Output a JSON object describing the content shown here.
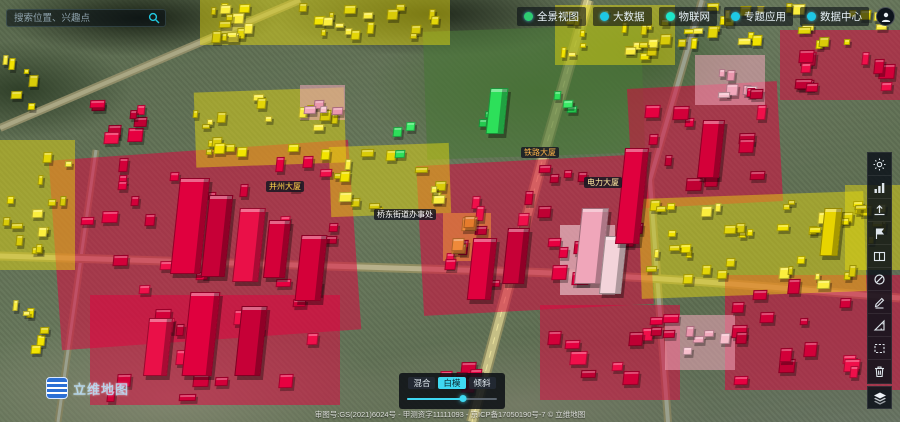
{
  "search": {
    "placeholder": "搜索位置、兴趣点"
  },
  "nav": {
    "items": [
      {
        "label": "全景视图",
        "icon": "panorama-icon",
        "color": "#2ecc71"
      },
      {
        "label": "大数据",
        "icon": "big-data-icon",
        "color": "#1ec8e6"
      },
      {
        "label": "物联网",
        "icon": "iot-icon",
        "color": "#1ee6c8"
      },
      {
        "label": "专题应用",
        "icon": "thematic-apps-icon",
        "color": "#1ec8e6"
      },
      {
        "label": "数据中心",
        "icon": "data-center-icon",
        "color": "#1ec8e6"
      }
    ]
  },
  "toolbar": {
    "buttons": [
      "brightness",
      "statistics",
      "submit-view",
      "flag-mark",
      "split-screen",
      "disable-rotate",
      "draw-pencil",
      "measure",
      "select-area",
      "clear-delete"
    ],
    "layers_button": "layers"
  },
  "mode_panel": {
    "buttons": [
      {
        "label": "混合",
        "active": false
      },
      {
        "label": "白模",
        "active": true
      },
      {
        "label": "倾斜",
        "active": false
      }
    ],
    "slider_percent": 62
  },
  "branding": {
    "watermark": "立维地图",
    "attribution": "审图号:GS(2021)6024号 - 甲测资字11111093 - 京ICP备17050190号-7 © 立维地图"
  },
  "theme": {
    "accent_cyan": "#3fd8f2",
    "building_red": "#e60040",
    "building_yellow": "#f2e300",
    "building_pink": "#f0a6ba",
    "building_green": "#2de05a",
    "building_orange": "#ef8a3a"
  },
  "map": {
    "labels": [
      {
        "text": "并州大厦",
        "x": 266,
        "y": 181,
        "tc": "#ffd24a"
      },
      {
        "text": "桥东街道办事处",
        "x": 374,
        "y": 209,
        "tc": "#ffffff"
      },
      {
        "text": "铁路大厦",
        "x": 521,
        "y": 147,
        "tc": "#ffb34a"
      },
      {
        "text": "电力大厦",
        "x": 584,
        "y": 177,
        "tc": "#ffe9a0"
      }
    ],
    "zones": [
      {
        "x": 425,
        "y": 28,
        "w": 218,
        "h": 128,
        "c": "Gp",
        "r": -2
      },
      {
        "x": 55,
        "y": 150,
        "w": 300,
        "h": 190,
        "c": "R",
        "r": -4
      },
      {
        "x": 420,
        "y": 160,
        "w": 230,
        "h": 150,
        "c": "R",
        "r": -3
      },
      {
        "x": 630,
        "y": 85,
        "w": 150,
        "h": 120,
        "c": "R",
        "r": -3
      },
      {
        "x": 725,
        "y": 275,
        "w": 180,
        "h": 115,
        "c": "R",
        "r": 0
      },
      {
        "x": 90,
        "y": 295,
        "w": 250,
        "h": 110,
        "c": "R",
        "r": 0
      },
      {
        "x": 540,
        "y": 305,
        "w": 140,
        "h": 95,
        "c": "R",
        "r": 0
      },
      {
        "x": 780,
        "y": 30,
        "w": 120,
        "h": 70,
        "c": "R",
        "r": 0
      },
      {
        "x": 640,
        "y": 195,
        "w": 225,
        "h": 100,
        "c": "Y",
        "r": -2
      },
      {
        "x": 195,
        "y": 90,
        "w": 150,
        "h": 75,
        "c": "Y",
        "r": -2
      },
      {
        "x": 0,
        "y": 140,
        "w": 75,
        "h": 130,
        "c": "Y",
        "r": 0
      },
      {
        "x": 200,
        "y": 0,
        "w": 250,
        "h": 45,
        "c": "Y",
        "r": 0
      },
      {
        "x": 555,
        "y": 5,
        "w": 120,
        "h": 60,
        "c": "Y",
        "r": 0
      },
      {
        "x": 845,
        "y": 185,
        "w": 55,
        "h": 85,
        "c": "Y",
        "r": 0
      },
      {
        "x": 330,
        "y": 145,
        "w": 120,
        "h": 70,
        "c": "Y",
        "r": -2
      },
      {
        "x": 695,
        "y": 55,
        "w": 70,
        "h": 50,
        "c": "P",
        "r": 0
      },
      {
        "x": 665,
        "y": 315,
        "w": 70,
        "h": 55,
        "c": "P",
        "r": 0
      },
      {
        "x": 560,
        "y": 225,
        "w": 55,
        "h": 70,
        "c": "W",
        "r": 0
      },
      {
        "x": 300,
        "y": 85,
        "w": 45,
        "h": 35,
        "c": "P",
        "r": 0
      },
      {
        "x": 443,
        "y": 213,
        "w": 48,
        "h": 48,
        "c": "O",
        "r": 0
      }
    ],
    "clusters": [
      {
        "x": 205,
        "y": 2,
        "w": 235,
        "h": 42,
        "c": "Y",
        "n": 30
      },
      {
        "x": 560,
        "y": 8,
        "w": 115,
        "h": 55,
        "c": "Y",
        "n": 18
      },
      {
        "x": 648,
        "y": 2,
        "w": 245,
        "h": 48,
        "c": "Y",
        "n": 28
      },
      {
        "x": 700,
        "y": 55,
        "w": 65,
        "h": 45,
        "c": "P",
        "n": 6
      },
      {
        "x": 790,
        "y": 32,
        "w": 108,
        "h": 62,
        "c": "R",
        "n": 10
      },
      {
        "x": 640,
        "y": 88,
        "w": 135,
        "h": 110,
        "c": "R",
        "n": 14
      },
      {
        "x": 55,
        "y": 88,
        "w": 95,
        "h": 62,
        "c": "R",
        "n": 8
      },
      {
        "x": 2,
        "y": 145,
        "w": 70,
        "h": 120,
        "c": "Y",
        "n": 14
      },
      {
        "x": 2,
        "y": 52,
        "w": 45,
        "h": 60,
        "c": "Y",
        "n": 6
      },
      {
        "x": 192,
        "y": 92,
        "w": 150,
        "h": 70,
        "c": "Y",
        "n": 20
      },
      {
        "x": 300,
        "y": 85,
        "w": 45,
        "h": 32,
        "c": "P",
        "n": 4
      },
      {
        "x": 332,
        "y": 148,
        "w": 118,
        "h": 65,
        "c": "Y",
        "n": 14
      },
      {
        "x": 62,
        "y": 152,
        "w": 285,
        "h": 155,
        "c": "R",
        "n": 24
      },
      {
        "x": 430,
        "y": 158,
        "w": 215,
        "h": 145,
        "c": "R",
        "n": 22
      },
      {
        "x": 445,
        "y": 215,
        "w": 46,
        "h": 46,
        "c": "O",
        "n": 4
      },
      {
        "x": 645,
        "y": 198,
        "w": 212,
        "h": 92,
        "c": "Y",
        "n": 34
      },
      {
        "x": 848,
        "y": 188,
        "w": 50,
        "h": 80,
        "c": "Y",
        "n": 8
      },
      {
        "x": 728,
        "y": 278,
        "w": 168,
        "h": 108,
        "c": "R",
        "n": 15
      },
      {
        "x": 545,
        "y": 308,
        "w": 135,
        "h": 88,
        "c": "R",
        "n": 12
      },
      {
        "x": 668,
        "y": 318,
        "w": 62,
        "h": 52,
        "c": "P",
        "n": 5
      },
      {
        "x": 95,
        "y": 298,
        "w": 240,
        "h": 105,
        "c": "R",
        "n": 16
      },
      {
        "x": 478,
        "y": 85,
        "w": 32,
        "h": 48,
        "c": "G",
        "n": 3
      },
      {
        "x": 552,
        "y": 85,
        "w": 36,
        "h": 30,
        "c": "G",
        "n": 3
      },
      {
        "x": 392,
        "y": 115,
        "w": 30,
        "h": 45,
        "c": "G",
        "n": 3
      },
      {
        "x": 428,
        "y": 355,
        "w": 60,
        "h": 40,
        "c": "R",
        "n": 5
      },
      {
        "x": 2,
        "y": 300,
        "w": 55,
        "h": 55,
        "c": "Y",
        "n": 6
      }
    ],
    "towers": [
      {
        "x": 175,
        "y": 178,
        "w": 30,
        "h": 96,
        "c": "#e0003e"
      },
      {
        "x": 205,
        "y": 195,
        "w": 24,
        "h": 82,
        "c": "#c70037"
      },
      {
        "x": 236,
        "y": 208,
        "w": 26,
        "h": 74,
        "c": "#ea1048"
      },
      {
        "x": 266,
        "y": 220,
        "w": 22,
        "h": 58,
        "c": "#d40039"
      },
      {
        "x": 186,
        "y": 292,
        "w": 30,
        "h": 84,
        "c": "#e0003e"
      },
      {
        "x": 238,
        "y": 306,
        "w": 26,
        "h": 70,
        "c": "#c70037"
      },
      {
        "x": 146,
        "y": 318,
        "w": 24,
        "h": 58,
        "c": "#ea1048"
      },
      {
        "x": 298,
        "y": 235,
        "w": 26,
        "h": 66,
        "c": "#d40039"
      },
      {
        "x": 470,
        "y": 238,
        "w": 24,
        "h": 62,
        "c": "#e0003e"
      },
      {
        "x": 505,
        "y": 228,
        "w": 22,
        "h": 56,
        "c": "#c70037"
      },
      {
        "x": 578,
        "y": 208,
        "w": 27,
        "h": 76,
        "c": "#f0a6ba"
      },
      {
        "x": 602,
        "y": 236,
        "w": 22,
        "h": 58,
        "c": "#f3d4da"
      },
      {
        "x": 488,
        "y": 88,
        "w": 18,
        "h": 46,
        "c": "#2de05a"
      },
      {
        "x": 620,
        "y": 148,
        "w": 24,
        "h": 96,
        "c": "#e0003e"
      },
      {
        "x": 700,
        "y": 120,
        "w": 22,
        "h": 58,
        "c": "#d40039"
      },
      {
        "x": 822,
        "y": 208,
        "w": 18,
        "h": 48,
        "c": "#e8d400"
      }
    ]
  }
}
